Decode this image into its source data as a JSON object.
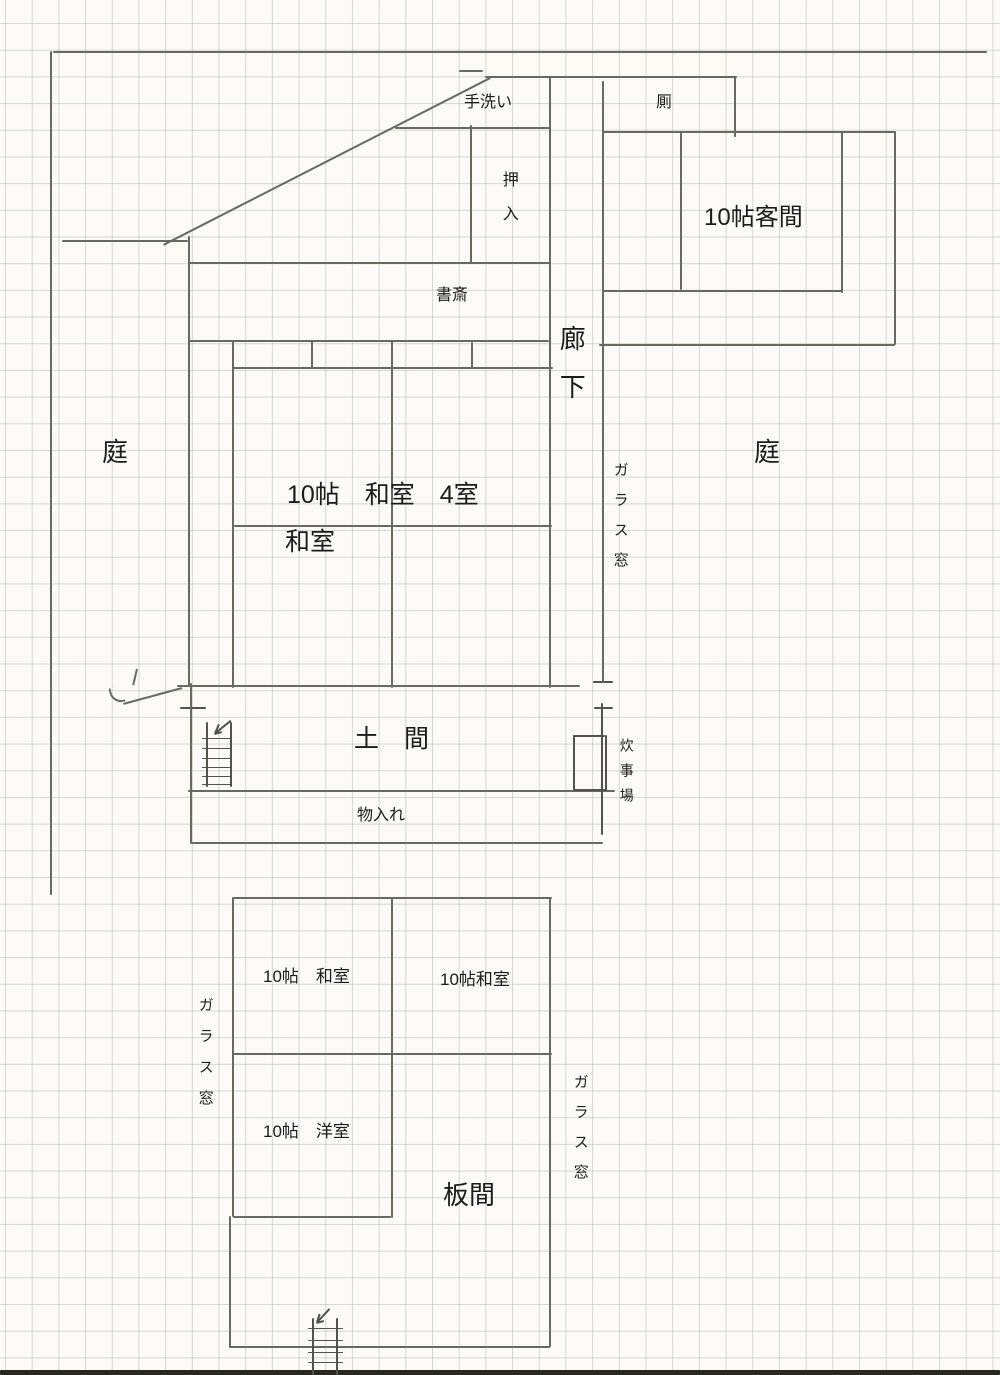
{
  "colors": {
    "paper": "#fbfaf6",
    "grid": "#969e92",
    "pencil": "#6a695f",
    "pencil_dark": "#53524b",
    "scan_edge": "#27261f",
    "text": "#1c1b18"
  },
  "labels": {
    "tearai": {
      "text": "手洗い",
      "x": 464,
      "y": 95,
      "size": 16,
      "dir": "h"
    },
    "kawaya": {
      "text": "厠",
      "x": 656,
      "y": 95,
      "size": 16,
      "dir": "h"
    },
    "oshiire": {
      "text": "押入",
      "x": 499,
      "y": 171,
      "size": 16,
      "dir": "v",
      "ls": 18
    },
    "kyakuma": {
      "text": "10帖客間",
      "x": 704,
      "y": 205,
      "size": 24,
      "dir": "h"
    },
    "shosai": {
      "text": "書斎",
      "x": 436,
      "y": 288,
      "size": 16,
      "dir": "h"
    },
    "rouka": {
      "text": "廊下",
      "x": 557,
      "y": 325,
      "size": 26,
      "dir": "v",
      "ls": 22
    },
    "niwa_west": {
      "text": "庭",
      "x": 102,
      "y": 439,
      "size": 26,
      "dir": "h"
    },
    "niwa_east": {
      "text": "庭",
      "x": 754,
      "y": 439,
      "size": 26,
      "dir": "h"
    },
    "washitsu_4": {
      "text": "10帖　和室　4室",
      "x": 287,
      "y": 482,
      "size": 25,
      "dir": "h"
    },
    "washitsu": {
      "text": "和室",
      "x": 285,
      "y": 529,
      "size": 25,
      "dir": "h"
    },
    "glass_east": {
      "text": "ガラス窓",
      "x": 612,
      "y": 462,
      "size": 15,
      "dir": "v",
      "ls": 15
    },
    "doma": {
      "text": "土　間",
      "x": 354,
      "y": 726,
      "size": 25,
      "dir": "h"
    },
    "suijiba": {
      "text": "炊事場",
      "x": 619,
      "y": 738,
      "size": 14,
      "dir": "v",
      "ls": 11
    },
    "monoire": {
      "text": "物入れ",
      "x": 357,
      "y": 808,
      "size": 16,
      "dir": "h"
    },
    "washitsu_sw": {
      "text": "10帖　和室",
      "x": 263,
      "y": 968,
      "size": 17,
      "dir": "h"
    },
    "washitsu_se": {
      "text": "10帖和室",
      "x": 440,
      "y": 971,
      "size": 17,
      "dir": "h"
    },
    "glass_west": {
      "text": "ガラス窓",
      "x": 197,
      "y": 997,
      "size": 15,
      "dir": "v",
      "ls": 16
    },
    "yoshitsu": {
      "text": "10帖　洋室",
      "x": 263,
      "y": 1123,
      "size": 17,
      "dir": "h"
    },
    "itanoma": {
      "text": "板間",
      "x": 443,
      "y": 1182,
      "size": 26,
      "dir": "h"
    },
    "glass_south": {
      "text": "ガラス窓",
      "x": 572,
      "y": 1074,
      "size": 15,
      "dir": "v",
      "ls": 15
    }
  },
  "geometry": {
    "h": [
      [
        53,
        51,
        934
      ],
      [
        62,
        240,
        126
      ],
      [
        459,
        70,
        24
      ],
      [
        485,
        76,
        252
      ],
      [
        395,
        127,
        155
      ],
      [
        188,
        262,
        362
      ],
      [
        602,
        131,
        293
      ],
      [
        602,
        290,
        240
      ],
      [
        599,
        344,
        296
      ],
      [
        189,
        340,
        360
      ],
      [
        233,
        367,
        320
      ],
      [
        234,
        525,
        318
      ],
      [
        177,
        685,
        403
      ],
      [
        180,
        707,
        26,
        2,
        "dark"
      ],
      [
        188,
        790,
        427
      ],
      [
        190,
        842,
        413
      ],
      [
        593,
        681,
        20,
        2,
        "dark"
      ],
      [
        594,
        707,
        19,
        2,
        "dark"
      ],
      [
        573,
        735,
        32,
        2,
        "dark"
      ],
      [
        573,
        789,
        34,
        2,
        "dark"
      ],
      [
        202,
        738,
        29,
        1,
        "dark"
      ],
      [
        202,
        748,
        29,
        1,
        "dark"
      ],
      [
        202,
        758,
        29,
        1,
        "dark"
      ],
      [
        202,
        767,
        29,
        1,
        "dark"
      ],
      [
        202,
        776,
        29,
        1,
        "dark"
      ],
      [
        202,
        784,
        29,
        1,
        "dark"
      ],
      [
        233,
        897,
        319
      ],
      [
        233,
        1053,
        319
      ],
      [
        233,
        1216,
        158
      ],
      [
        229,
        1346,
        321
      ],
      [
        308,
        1328,
        35,
        1,
        "dark"
      ],
      [
        308,
        1340,
        35,
        1,
        "dark"
      ],
      [
        308,
        1352,
        35,
        1,
        "dark"
      ],
      [
        308,
        1362,
        35,
        1,
        "dark"
      ],
      [
        308,
        1370,
        35,
        1,
        "dark"
      ],
      [
        0,
        1370,
        1000,
        5,
        "edge"
      ]
    ],
    "v": [
      [
        50,
        51,
        844
      ],
      [
        188,
        236,
        450
      ],
      [
        549,
        76,
        612
      ],
      [
        470,
        125,
        138
      ],
      [
        602,
        81,
        602
      ],
      [
        734,
        77,
        60
      ],
      [
        680,
        131,
        159
      ],
      [
        841,
        131,
        162
      ],
      [
        894,
        131,
        214
      ],
      [
        311,
        341,
        27
      ],
      [
        471,
        342,
        26
      ],
      [
        232,
        340,
        348
      ],
      [
        391,
        341,
        347
      ],
      [
        190,
        683,
        160
      ],
      [
        601,
        703,
        132,
        2,
        "dark"
      ],
      [
        232,
        897,
        320
      ],
      [
        229,
        1216,
        131
      ],
      [
        391,
        897,
        321
      ],
      [
        549,
        897,
        450
      ],
      [
        206,
        722,
        65,
        2,
        "dark"
      ],
      [
        230,
        722,
        65,
        2,
        "dark"
      ],
      [
        573,
        735,
        55,
        2,
        "dark"
      ],
      [
        605,
        735,
        55,
        2,
        "dark"
      ],
      [
        312,
        1318,
        57,
        2,
        "dark"
      ],
      [
        336,
        1318,
        57,
        2,
        "dark"
      ]
    ],
    "diag": [
      [
        163,
        244,
        490,
        77
      ],
      [
        123,
        703,
        182,
        687
      ],
      [
        138,
        669,
        134,
        686
      ],
      [
        214,
        733,
        230,
        720,
        "dark"
      ],
      [
        214,
        733,
        218,
        724,
        "dark"
      ],
      [
        214,
        733,
        222,
        731,
        "dark"
      ],
      [
        316,
        1322,
        329,
        1308,
        "dark"
      ],
      [
        316,
        1322,
        319,
        1313,
        "dark"
      ],
      [
        316,
        1322,
        324,
        1320,
        "dark"
      ]
    ]
  }
}
